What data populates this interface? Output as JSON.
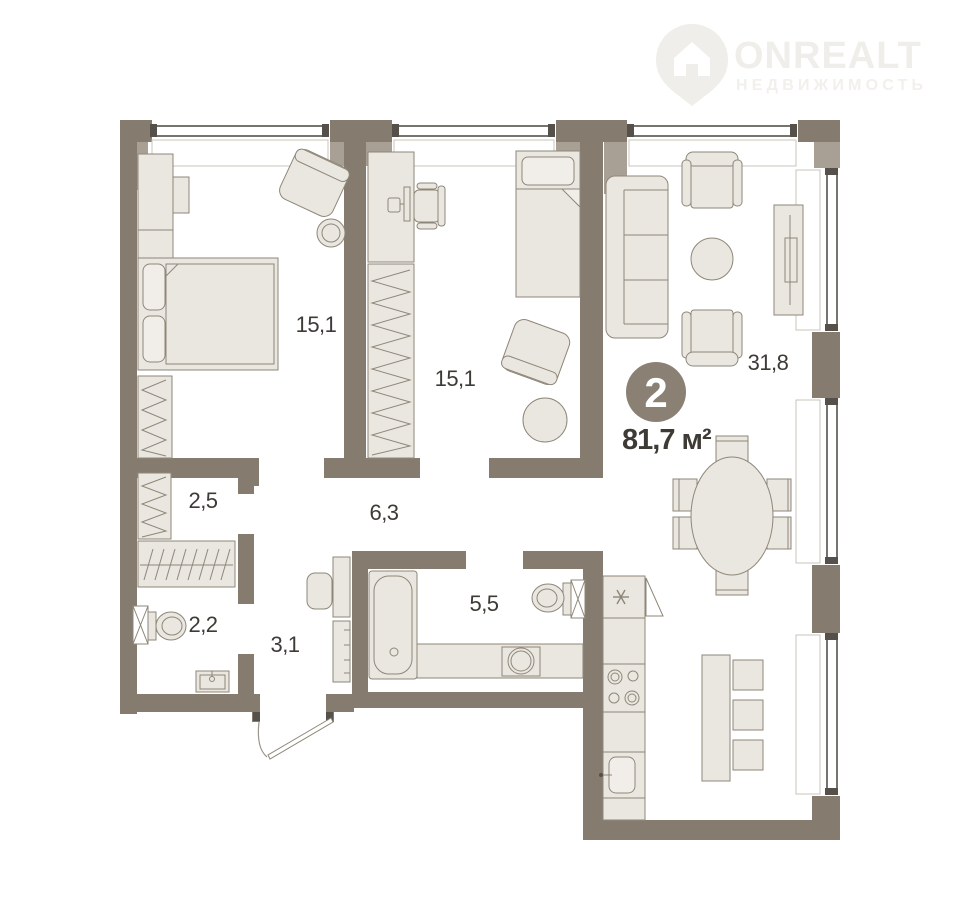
{
  "logo": {
    "brand": "ONREALT",
    "subtitle": "НЕДВИЖИМОСТЬ"
  },
  "plan": {
    "rooms_badge": "2",
    "total_area_label": "81,7 м²",
    "rooms": [
      {
        "name": "bedroom-1",
        "area": "15,1"
      },
      {
        "name": "bedroom-2",
        "area": "15,1"
      },
      {
        "name": "living-kitchen",
        "area": "31,8"
      },
      {
        "name": "wardrobe",
        "area": "2,5"
      },
      {
        "name": "corridor",
        "area": "6,3"
      },
      {
        "name": "wc",
        "area": "2,2"
      },
      {
        "name": "hallway",
        "area": "3,1"
      },
      {
        "name": "bathroom",
        "area": "5,5"
      }
    ]
  },
  "colors": {
    "bg": "#ffffff",
    "wall": "#857c6f",
    "wall_light": "#a8a095",
    "furn": "#eae6e0",
    "furn2": "#f1eee9",
    "furn_stroke": "#8e8779",
    "glass": "#55504a",
    "niche": "#c9c4bb",
    "text": "#3e3b36",
    "badge_bg": "#8a8174",
    "logo": "#f0eeea",
    "logo2": "#f2f0ed"
  }
}
